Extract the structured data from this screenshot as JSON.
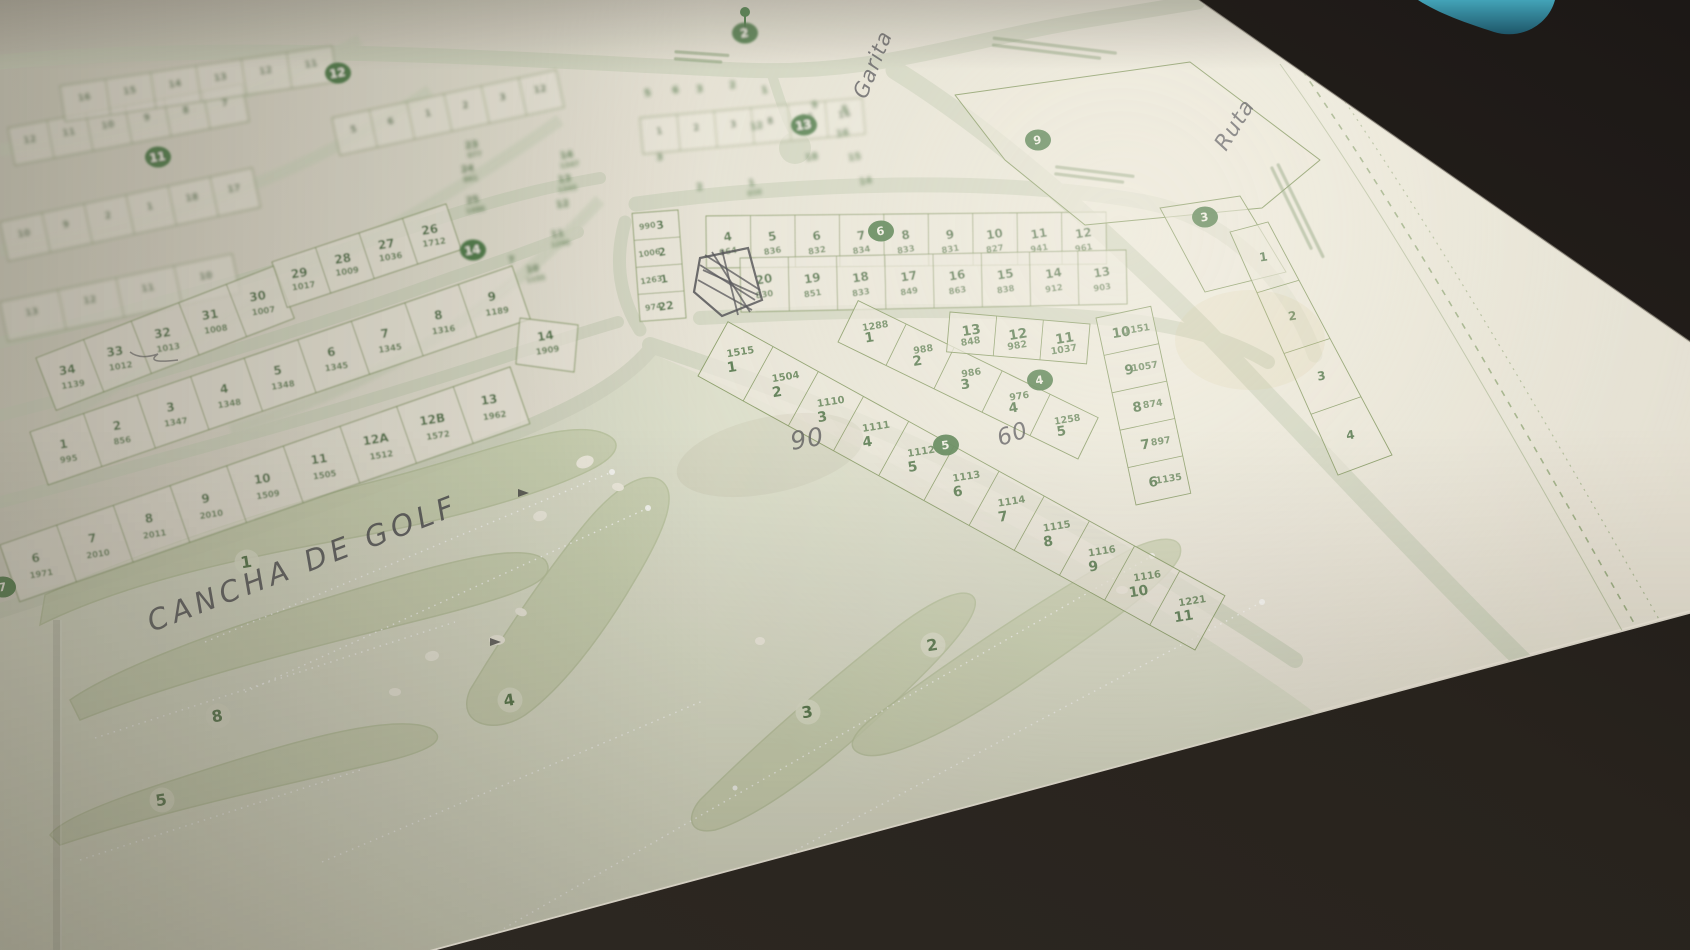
{
  "scene": {
    "description": "Photograph of a printed plat map of a golf-course residential subdivision on a dark desk",
    "paper_color": "#e7e2d2",
    "print_green": "#4c7140",
    "marker_green": "#3f7439",
    "desk_color": "#241f1a",
    "blue_object_color": "#2f8ba1"
  },
  "handwriting": [
    {
      "text": "CANCHA DE GOLF",
      "x": 152,
      "y": 632,
      "rot": -21,
      "fs": 29,
      "ls": 5
    },
    {
      "text": "Garita",
      "x": 866,
      "y": 100,
      "rot": -68,
      "fs": 21,
      "ls": 1
    },
    {
      "text": "Ruta",
      "x": 1226,
      "y": 152,
      "rot": -58,
      "fs": 22,
      "ls": 1
    },
    {
      "text": "90",
      "x": 792,
      "y": 450,
      "rot": -10,
      "fs": 25,
      "ls": 1
    },
    {
      "text": "60",
      "x": 1000,
      "y": 446,
      "rot": -18,
      "fs": 23,
      "ls": 1
    }
  ],
  "block_markers": [
    {
      "n": "2",
      "x": 745,
      "y": 33,
      "blur": true
    },
    {
      "n": "13",
      "x": 804,
      "y": 125,
      "blur": true
    },
    {
      "n": "9",
      "x": 1038,
      "y": 140,
      "blur": false
    },
    {
      "n": "3",
      "x": 1205,
      "y": 217,
      "blur": false
    },
    {
      "n": "6",
      "x": 881,
      "y": 231,
      "blur": false
    },
    {
      "n": "14",
      "x": 473,
      "y": 250,
      "blur": true
    },
    {
      "n": "4",
      "x": 1040,
      "y": 380,
      "blur": false
    },
    {
      "n": "5",
      "x": 946,
      "y": 445,
      "blur": false
    },
    {
      "n": "7",
      "x": 3,
      "y": 587,
      "blur": false
    },
    {
      "n": "11",
      "x": 158,
      "y": 157,
      "blur": true
    },
    {
      "n": "12",
      "x": 338,
      "y": 73,
      "blur": true
    }
  ],
  "golf": {
    "holes": [
      {
        "n": "1",
        "x": 247,
        "y": 562
      },
      {
        "n": "8",
        "x": 218,
        "y": 716
      },
      {
        "n": "5",
        "x": 162,
        "y": 800
      },
      {
        "n": "4",
        "x": 510,
        "y": 700
      },
      {
        "n": "3",
        "x": 808,
        "y": 712
      },
      {
        "n": "2",
        "x": 933,
        "y": 645
      }
    ]
  },
  "blocks": {
    "row_a_top": [
      [
        "4",
        "964"
      ],
      [
        "5",
        "836"
      ],
      [
        "6",
        "832"
      ],
      [
        "7",
        "834"
      ],
      [
        "8",
        "833"
      ],
      [
        "9",
        "831"
      ],
      [
        "10",
        "827"
      ],
      [
        "11",
        "941"
      ],
      [
        "12",
        "961"
      ]
    ],
    "row_a_bottom": [
      [
        "20",
        "830"
      ],
      [
        "19",
        "851"
      ],
      [
        "18",
        "833"
      ],
      [
        "17",
        "849"
      ],
      [
        "16",
        "863"
      ],
      [
        "15",
        "838"
      ],
      [
        "14",
        "912"
      ],
      [
        "13",
        "903"
      ]
    ],
    "mini_block": [
      [
        "3",
        "990"
      ],
      [
        "2",
        "1006"
      ],
      [
        "1",
        "1263"
      ],
      [
        "22",
        "974"
      ]
    ],
    "rb_diag": [
      [
        "1",
        "1288"
      ],
      [
        "2",
        "988"
      ],
      [
        "3",
        "986"
      ],
      [
        "4",
        "976"
      ],
      [
        "5",
        "1258"
      ]
    ],
    "rb_top": [
      [
        "13",
        "848"
      ],
      [
        "12",
        "982"
      ],
      [
        "11",
        "1037"
      ]
    ],
    "rb_right": [
      [
        "10",
        "1151"
      ],
      [
        "9",
        "1057"
      ],
      [
        "8",
        "874"
      ],
      [
        "7",
        "897"
      ],
      [
        "6",
        "1135"
      ]
    ],
    "rc_diag": [
      [
        "1",
        "1515"
      ],
      [
        "2",
        "1504"
      ],
      [
        "3",
        "1110"
      ],
      [
        "4",
        "1111"
      ],
      [
        "5",
        "1112"
      ],
      [
        "6",
        "1113"
      ],
      [
        "7",
        "1114"
      ],
      [
        "8",
        "1115"
      ],
      [
        "9",
        "1116"
      ],
      [
        "10",
        "1116"
      ],
      [
        "11",
        "1221"
      ]
    ],
    "left_1": [
      [
        "34",
        "1139"
      ],
      [
        "33",
        "1012"
      ],
      [
        "32",
        "1013"
      ],
      [
        "31",
        "1008"
      ],
      [
        "30",
        "1007"
      ]
    ],
    "left_1b": [
      [
        "29",
        "1017"
      ],
      [
        "28",
        "1009"
      ],
      [
        "27",
        "1036"
      ],
      [
        "26",
        "1712"
      ]
    ],
    "left_2": [
      [
        "1",
        "995"
      ],
      [
        "2",
        "856"
      ],
      [
        "3",
        "1347"
      ],
      [
        "4",
        "1348"
      ],
      [
        "5",
        "1348"
      ],
      [
        "6",
        "1345"
      ],
      [
        "7",
        "1345"
      ],
      [
        "8",
        "1316"
      ],
      [
        "9",
        "1189"
      ]
    ],
    "left_3": [
      [
        "6",
        "1971"
      ],
      [
        "7",
        "2010"
      ],
      [
        "8",
        "2011"
      ],
      [
        "9",
        "2010"
      ],
      [
        "10",
        "1509"
      ],
      [
        "11",
        "1505"
      ],
      [
        "12A",
        "1512"
      ],
      [
        "12B",
        "1572"
      ],
      [
        "13",
        "1962"
      ]
    ],
    "corner_lot": [
      [
        "14",
        "1909"
      ]
    ],
    "right_column": [
      [
        "1",
        ""
      ],
      [
        "2",
        ""
      ],
      [
        "3",
        ""
      ],
      [
        "4",
        ""
      ]
    ]
  },
  "blur_rows": [
    [
      "12",
      "11",
      "10",
      "9",
      "8",
      "7"
    ],
    [
      "16",
      "15",
      "14",
      "13",
      "12",
      "11"
    ],
    [
      "10",
      "9",
      "2",
      "1",
      "18",
      "17"
    ],
    [
      "5",
      "6",
      "1",
      "2",
      "3",
      "12"
    ],
    [
      "1",
      "2",
      "3",
      "8",
      "15",
      "16"
    ],
    [
      "13",
      "12",
      "11",
      "10"
    ]
  ],
  "faint_labels": [
    {
      "n": "25",
      "a": "1486",
      "x": 473,
      "y": 203
    },
    {
      "n": "24",
      "a": "861",
      "x": 468,
      "y": 172
    },
    {
      "n": "23",
      "a": "977",
      "x": 472,
      "y": 148
    },
    {
      "n": "14",
      "a": "1347",
      "x": 567,
      "y": 158
    },
    {
      "n": "13",
      "a": "1345",
      "x": 565,
      "y": 182
    },
    {
      "n": "12",
      "a": "",
      "x": 563,
      "y": 207
    },
    {
      "n": "11",
      "a": "1290",
      "x": 558,
      "y": 237
    },
    {
      "n": "10",
      "a": "1155",
      "x": 533,
      "y": 272
    },
    {
      "n": "7",
      "a": "",
      "x": 512,
      "y": 263
    },
    {
      "n": "3",
      "a": "",
      "x": 700,
      "y": 92
    },
    {
      "n": "2",
      "a": "",
      "x": 733,
      "y": 88
    },
    {
      "n": "1",
      "a": "",
      "x": 765,
      "y": 93
    },
    {
      "n": "12",
      "a": "",
      "x": 757,
      "y": 129
    },
    {
      "n": "16",
      "a": "",
      "x": 843,
      "y": 136
    },
    {
      "n": "15",
      "a": "",
      "x": 855,
      "y": 160
    },
    {
      "n": "14",
      "a": "",
      "x": 866,
      "y": 184
    },
    {
      "n": "9",
      "a": "",
      "x": 815,
      "y": 108
    },
    {
      "n": "8",
      "a": "",
      "x": 845,
      "y": 112
    },
    {
      "n": "5",
      "a": "",
      "x": 648,
      "y": 96
    },
    {
      "n": "6",
      "a": "",
      "x": 676,
      "y": 93
    },
    {
      "n": "1",
      "a": "858",
      "x": 752,
      "y": 186
    },
    {
      "n": "18",
      "a": "",
      "x": 812,
      "y": 160
    },
    {
      "n": "2",
      "a": "",
      "x": 700,
      "y": 190
    },
    {
      "n": "3",
      "a": "",
      "x": 660,
      "y": 160
    }
  ],
  "illegible_texts": [
    {
      "location": "top-right two printed lines"
    },
    {
      "location": "inside top commercial parcel"
    },
    {
      "location": "right border, rotated along road"
    },
    {
      "location": "top-center below entrance circle"
    }
  ]
}
